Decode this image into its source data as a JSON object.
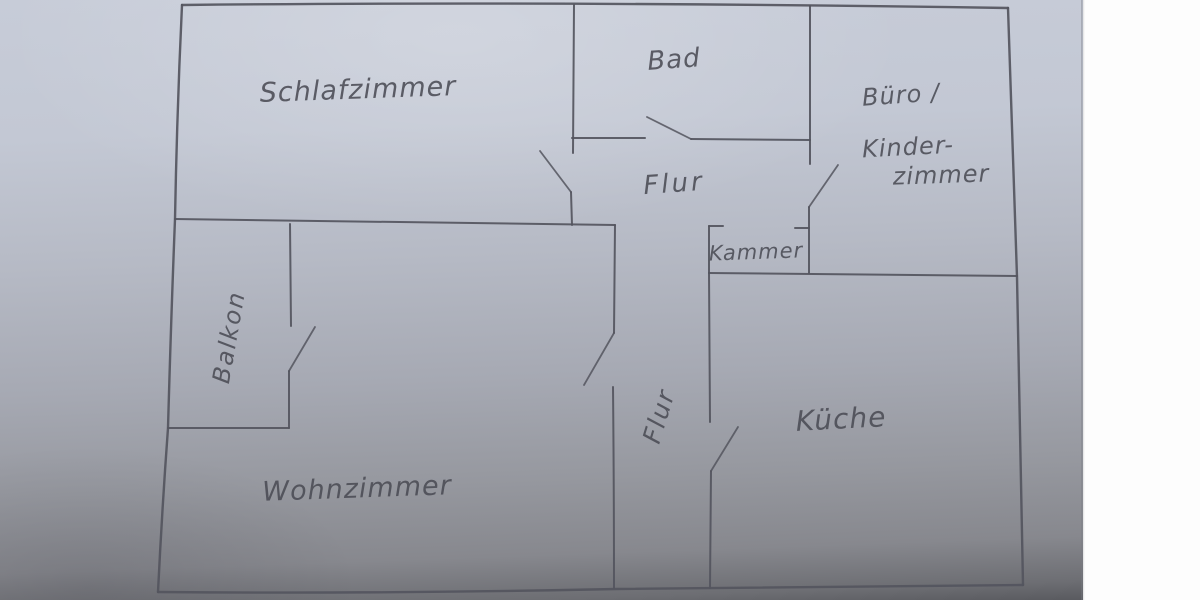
{
  "photo": {
    "description": "hand-drawn pencil floor plan on grey-blue paper, white backing visible on the right edge",
    "paper_color_top": "#c7ccd8",
    "paper_color_bottom": "#595a5f",
    "pencil_color": "#54555e",
    "background_color": "#fdfdfd"
  },
  "labels": {
    "schlafzimmer": "Schlafzimmer",
    "bad": "Bad",
    "buero": "Büro /",
    "kinder": "Kinder-",
    "kinder_zimmer": "zimmer",
    "flur_upper": "Flur",
    "kammer": "Kammer",
    "balkon": "Balkon",
    "wohnzimmer": "Wohnzimmer",
    "flur_lower": "Flur",
    "kueche": "Küche"
  },
  "rooms": [
    {
      "name": "Schlafzimmer",
      "area": "top-left"
    },
    {
      "name": "Bad",
      "area": "top-middle"
    },
    {
      "name": "Büro / Kinderzimmer",
      "area": "top-right"
    },
    {
      "name": "Flur",
      "area": "center corridor"
    },
    {
      "name": "Kammer",
      "area": "small room center-right"
    },
    {
      "name": "Balkon",
      "area": "middle-left"
    },
    {
      "name": "Wohnzimmer",
      "area": "bottom-left"
    },
    {
      "name": "Flur",
      "area": "lower corridor"
    },
    {
      "name": "Küche",
      "area": "bottom-right"
    }
  ]
}
